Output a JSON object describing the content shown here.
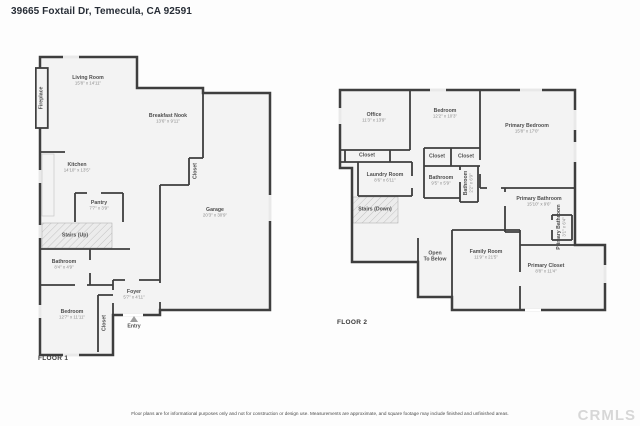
{
  "header": {
    "title": "39665 Foxtail Dr, Temecula, CA 92591"
  },
  "floor1": {
    "label": "FLOOR 1",
    "rooms": [
      {
        "name": "Living Room",
        "dims": "15'8\" x 14'11\"",
        "x": 53,
        "y": 26
      },
      {
        "name": "Breakfast Nook",
        "dims": "13'6\" x 9'11\"",
        "x": 133,
        "y": 64
      },
      {
        "name": "Kitchen",
        "dims": "14'10\" x 13'5\"",
        "x": 42,
        "y": 113
      },
      {
        "name": "Pantry",
        "dims": "7'7\" x 3'9\"",
        "x": 64,
        "y": 151
      },
      {
        "name": "Stairs (Up)",
        "x": 40,
        "y": 181
      },
      {
        "name": "Bathroom",
        "dims": "8'4\" x 4'9\"",
        "x": 29,
        "y": 210
      },
      {
        "name": "Bedroom",
        "dims": "12'7\" x 11'11\"",
        "x": 37,
        "y": 260
      },
      {
        "name": "Closet",
        "x": 70,
        "y": 268,
        "vertical": true
      },
      {
        "name": "Foyer",
        "dims": "5'7\" x 4'11\"",
        "x": 99,
        "y": 240
      },
      {
        "name": "Entry",
        "x": 99,
        "y": 272
      },
      {
        "name": "Garage",
        "dims": "20'3\" x 30'9\"",
        "x": 180,
        "y": 158
      },
      {
        "name": "Closet",
        "x": 161,
        "y": 116,
        "vertical": true
      },
      {
        "name": "Fireplace",
        "x": 7,
        "y": 43,
        "vertical": true
      }
    ]
  },
  "floor2": {
    "label": "FLOOR 2",
    "rooms": [
      {
        "name": "Office",
        "dims": "11'3\" x 13'9\"",
        "x": 39,
        "y": 38
      },
      {
        "name": "Bedroom",
        "dims": "12'2\" x 10'3\"",
        "x": 110,
        "y": 34
      },
      {
        "name": "Primary Bedroom",
        "dims": "15'8\" x 17'0\"",
        "x": 192,
        "y": 49
      },
      {
        "name": "Closet",
        "x": 32,
        "y": 76
      },
      {
        "name": "Closet",
        "x": 102,
        "y": 77
      },
      {
        "name": "Closet",
        "x": 131,
        "y": 77
      },
      {
        "name": "Laundry Room",
        "dims": "8'6\" x 6'11\"",
        "x": 50,
        "y": 98
      },
      {
        "name": "Bathroom",
        "dims": "9'5\" x 5'9\"",
        "x": 106,
        "y": 101
      },
      {
        "name": "Bathroom",
        "dims": "2'2\" x 6'9\"",
        "x": 134,
        "y": 103,
        "vertical": true
      },
      {
        "name": "Stairs (Down)",
        "x": 40,
        "y": 130
      },
      {
        "name": "Open\nTo Below",
        "x": 100,
        "y": 177
      },
      {
        "name": "Family Room",
        "dims": "11'9\" x 21'5\"",
        "x": 151,
        "y": 175
      },
      {
        "name": "Primary Bathroom",
        "dims": "15'10\" x 9'6\"",
        "x": 204,
        "y": 122
      },
      {
        "name": "Primary Bathroom",
        "dims": "3'1\" x 6'4\"",
        "x": 227,
        "y": 147,
        "vertical": true
      },
      {
        "name": "Primary Closet",
        "dims": "8'8\" x 11'4\"",
        "x": 211,
        "y": 189
      }
    ]
  },
  "footer": {
    "disclaimer": "Floor plans are for informational purposes only and not for construction or design use. Measurements are approximate, and square footage may include finished and unfinished areas.",
    "watermark": "CRMLS"
  },
  "colors": {
    "wall": "#3e3e3e",
    "floor_fill": "#f3f3f3",
    "watermark_gray": "#d7d7d7"
  }
}
